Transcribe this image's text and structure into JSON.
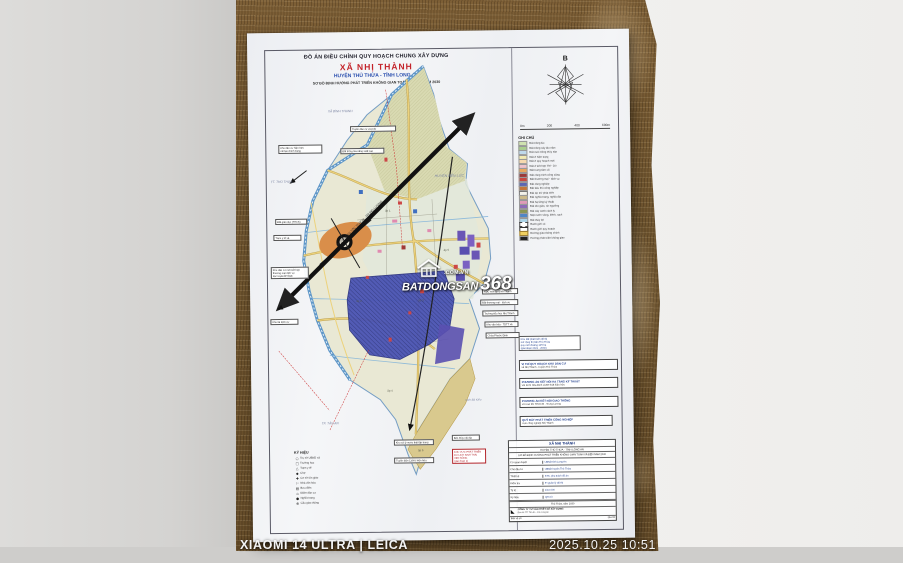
{
  "camera": {
    "watermark_left": "XIAOMI 14 ULTRA | LEICA",
    "watermark_right": "2025.10.25  10:51"
  },
  "doc": {
    "header": {
      "line1": "ĐỒ ÁN ĐIỀU CHỈNH QUY HOẠCH CHUNG XÂY DỰNG",
      "line2": "XÃ NHỊ THÀNH",
      "line3": "HUYỆN THỦ THỪA - TỈNH LONG AN",
      "line4": "SƠ ĐỒ ĐỊNH HƯỚNG PHÁT TRIỂN KHÔNG GIAN TOÀN XÃ ĐẾN NĂM 2030"
    },
    "compass": {
      "north": "B"
    },
    "scalebar": {
      "labels": [
        "0m",
        "200",
        "400",
        "600m"
      ]
    },
    "legend": {
      "title": "GHI CHÚ",
      "items": [
        {
          "sw": "background:#cfe3b0",
          "label": "Đất trồng lúa"
        },
        {
          "sw": "background:#a9cf8c",
          "label": "Đất trồng cây lâu năm"
        },
        {
          "sw": "background:#bfd9ec",
          "label": "Đất nuôi trồng thủy sản"
        },
        {
          "sw": "background:#f2eab2",
          "label": "Đất ở hiện trạng"
        },
        {
          "sw": "background:#f6d9ae",
          "label": "Đất ở quy hoạch mới"
        },
        {
          "sw": "background:#eec2cc",
          "label": "Đất ở kết hợp TM - DV"
        },
        {
          "sw": "background:#e8a85e",
          "label": "Đất trung tâm xã"
        },
        {
          "sw": "background:#9c3a38",
          "label": "Đất công trình công cộng"
        },
        {
          "sw": "background:#c94840",
          "label": "Đất thương mại - dịch vụ"
        },
        {
          "sw": "background:#5a66b5",
          "label": "Đất công nghiệp"
        },
        {
          "sw": "background:#c4763a",
          "label": "Đất tiểu thủ công nghiệp"
        },
        {
          "sw": "background:#f2f1ea;border:0.4px solid #777",
          "label": "Đất dự trữ phát triển"
        },
        {
          "sw": "background:#cbb98a",
          "label": "Đất nghĩa trang, nghĩa địa"
        },
        {
          "sw": "background:#e09ab8",
          "label": "Đất hạ tầng kỹ thuật"
        },
        {
          "sw": "background:#8d6bb8",
          "label": "Đất tôn giáo, tín ngưỡng"
        },
        {
          "sw": "background:#8a9652",
          "label": "Đất cây xanh cách ly"
        },
        {
          "sw": "background:#4f86c6",
          "label": "Mặt nước sông, kênh, rạch"
        },
        {
          "sw": "background:#a9d3e8",
          "label": "Đất thủy lợi"
        },
        {
          "sw": "background:#fff;border:0.4px dashed #444",
          "label": "Ranh giới xã"
        },
        {
          "sw": "background:#fff;border:0.6px solid #333",
          "label": "Ranh giới quy hoạch"
        },
        {
          "sw": "background:#f0d060;border:0.3px solid #a08030",
          "label": "Đường giao thông chính"
        },
        {
          "sw": "background:#222",
          "label": "Hướng phát triển không gian"
        }
      ]
    },
    "kyhieu": {
      "title": "KÝ HIỆU",
      "items": [
        {
          "glyph": "○",
          "label": "Trụ sở UBND xã"
        },
        {
          "glyph": "□",
          "label": "Trường học"
        },
        {
          "glyph": "△",
          "label": "Trạm y tế"
        },
        {
          "glyph": "◆",
          "label": "Chợ"
        },
        {
          "glyph": "✚",
          "label": "Cơ sở tôn giáo"
        },
        {
          "glyph": "⚐",
          "label": "Nhà văn hóa"
        },
        {
          "glyph": "▤",
          "label": "Bưu điện"
        },
        {
          "glyph": "⌂",
          "label": "Điểm dân cư"
        },
        {
          "glyph": "●",
          "label": "Nghĩa trang"
        },
        {
          "glyph": "⊕",
          "label": "Cầu giao thông"
        }
      ]
    },
    "map_labels": {
      "neighbor_ne": "HUYỆN BẾN LỨC",
      "neighbor_nw": "XÃ BÌNH THẠNH",
      "neighbor_w": "TT. THỦ THỪA",
      "neighbor_s": "TP. TÂN AN",
      "water_s": "rạch Bà Kiểu",
      "expressway": "ĐƯỜNG CAO TỐC TP.HCM - TRUNG LƯƠNG",
      "hamlets": [
        "ấp 1",
        "ấp 2",
        "ấp 3",
        "ấp 4",
        "ấp 5",
        "ấp 6"
      ]
    },
    "callouts": {
      "left": [
        {
          "text": "Khu dân cư hiện hữu\ncải tạo chỉnh trang"
        },
        {
          "text": "Đất giáo dục (THCS)"
        },
        {
          "text": "Trạm y tế xã"
        },
        {
          "text": "Khu dân cư mới kết hợp\nthương mại dịch vụ\ndọc tuyến ĐT.818"
        },
        {
          "text": "Khu tái định cư"
        }
      ],
      "top": [
        {
          "text": "Tuyến dân cư vượt lũ"
        },
        {
          "text": "Đất trồng lúa năng suất cao"
        }
      ],
      "right_small": [
        {
          "text": "KDC mới ấp Bình Thạnh"
        },
        {
          "text": "Đất thương mại - dịch vụ"
        },
        {
          "text": "Trường tiểu học Nhị Thành"
        },
        {
          "text": "Khu văn hóa - TDTT xã"
        },
        {
          "text": "Chùa Phước Định"
        }
      ],
      "note_group": {
        "text": "Khu đất phát triển đô thị\nmở rộng thị trấn Thủ Thừa\nquy mô khoảng 125 ha\n(giai đoạn 2021 - 2030)"
      },
      "right_wide": [
        {
          "l1": "VỊ TRÍ QUY HOẠCH KHU DÂN CƯ",
          "l2": "xã Nhị Thành - huyện Thủ Thừa"
        },
        {
          "l1": "PHƯƠNG ÁN KẾT NỐI HẠ TẦNG KỸ THUẬT",
          "l2": "với KCN Hòa Bình và ĐT.818 hiện hữu"
        },
        {
          "l1": "PHƯƠNG ÁN KẾT NỐI GIAO THÔNG",
          "l2": "với cao tốc TP.HCM - Trung Lương"
        },
        {
          "l1": "QUỸ ĐẤT PHÁT TRIỂN CÔNG NGHIỆP",
          "l2": "cụm công nghiệp Nhị Thành"
        }
      ],
      "bottom": [
        {
          "text": "Khu xử lý nước thải tập trung"
        },
        {
          "text": "Tuyến điện 110kV hiện hữu"
        },
        {
          "text": "Bến thủy nội địa"
        },
        {
          "text": "KHU VỰC PHÁT TRIỂN\nDU LỊCH SINH THÁI\nVEN SÔNG\n(giai đoạn 2)"
        }
      ]
    },
    "watermark": {
      "domain": ".COM.VN",
      "brand": "BATDONGSAN",
      "number": "368"
    },
    "title_table": {
      "commune": "XÃ NHỊ THÀNH",
      "district": "HUYỆN THỦ THỪA - TỈNH LONG AN",
      "scheme": "SƠ ĐỒ ĐỊNH HƯỚNG PHÁT TRIỂN KHÔNG GIAN TOÀN XÃ ĐẾN NĂM 2030",
      "rows": [
        {
          "k": "Cơ quan duyệt",
          "v": "UBND tỉnh Long An"
        },
        {
          "k": "Chủ đầu tư",
          "v": "UBND huyện Thủ Thừa"
        },
        {
          "k": "Thiết kế",
          "v": "KTS. phụ trách đồ án"
        },
        {
          "k": "Kiểm tra",
          "v": "P. Quản lý đô thị"
        },
        {
          "k": "Tỷ lệ",
          "v": "1/10.000"
        },
        {
          "k": "Ký hiệu",
          "v": "QH-03"
        }
      ],
      "approval": "Thủ Thừa, năm 2030",
      "company": "CÔNG TY TƯ VẤN THIẾT KẾ XÂY DỰNG",
      "company_sub": "Địa chỉ: TP. Tân An - tỉnh Long An",
      "foot_left": "Bản vẽ số",
      "foot_right": "QH-03"
    },
    "colors": {
      "title_red": "#c3232a",
      "title_blue": "#2a4fae",
      "industry_zone": "#4a54b4",
      "center_orange": "#d98e4a",
      "river_blue": "#5f97c8"
    }
  }
}
